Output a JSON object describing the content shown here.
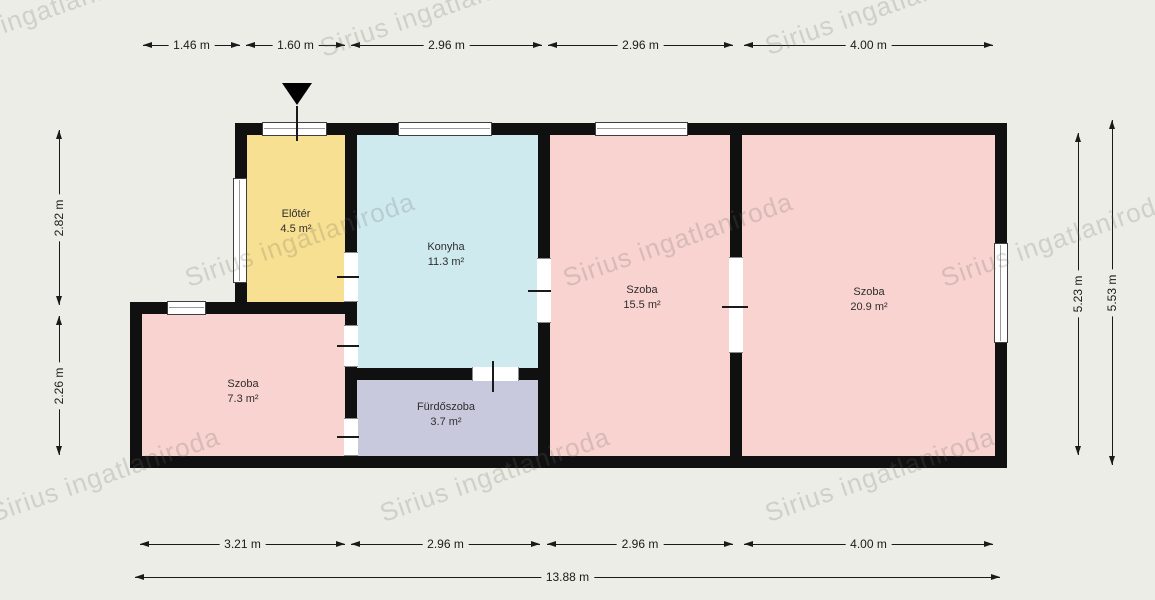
{
  "watermark": {
    "text": "Sirius ingatlaniroda"
  },
  "floorplan": {
    "rooms": [
      {
        "name": "Előtér",
        "area": "4.5 m²",
        "color": "#f8e092"
      },
      {
        "name": "Konyha",
        "area": "11.3 m²",
        "color": "#cfeaef"
      },
      {
        "name": "Szoba",
        "area": "15.5 m²",
        "color": "#f8d3cf"
      },
      {
        "name": "Szoba",
        "area": "20.9 m²",
        "color": "#f8d3cf"
      },
      {
        "name": "Szoba",
        "area": "7.3 m²",
        "color": "#f8d3cf"
      },
      {
        "name": "Fürdőszoba",
        "area": "3.7 m²",
        "color": "#c8c9dc"
      }
    ]
  },
  "dimensions": {
    "top": [
      "1.46 m",
      "1.60 m",
      "2.96 m",
      "2.96 m",
      "4.00 m"
    ],
    "bottom": [
      "3.21 m",
      "2.96 m",
      "2.96 m",
      "4.00 m"
    ],
    "total_width": "13.88 m",
    "left": [
      "2.82 m",
      "2.26 m"
    ],
    "right": [
      "5.23 m",
      "5.53 m"
    ]
  },
  "colors": {
    "background": "#edede7",
    "wall": "#101010",
    "window": "#ffffff",
    "watermark_gray": "#c9c9c1"
  }
}
